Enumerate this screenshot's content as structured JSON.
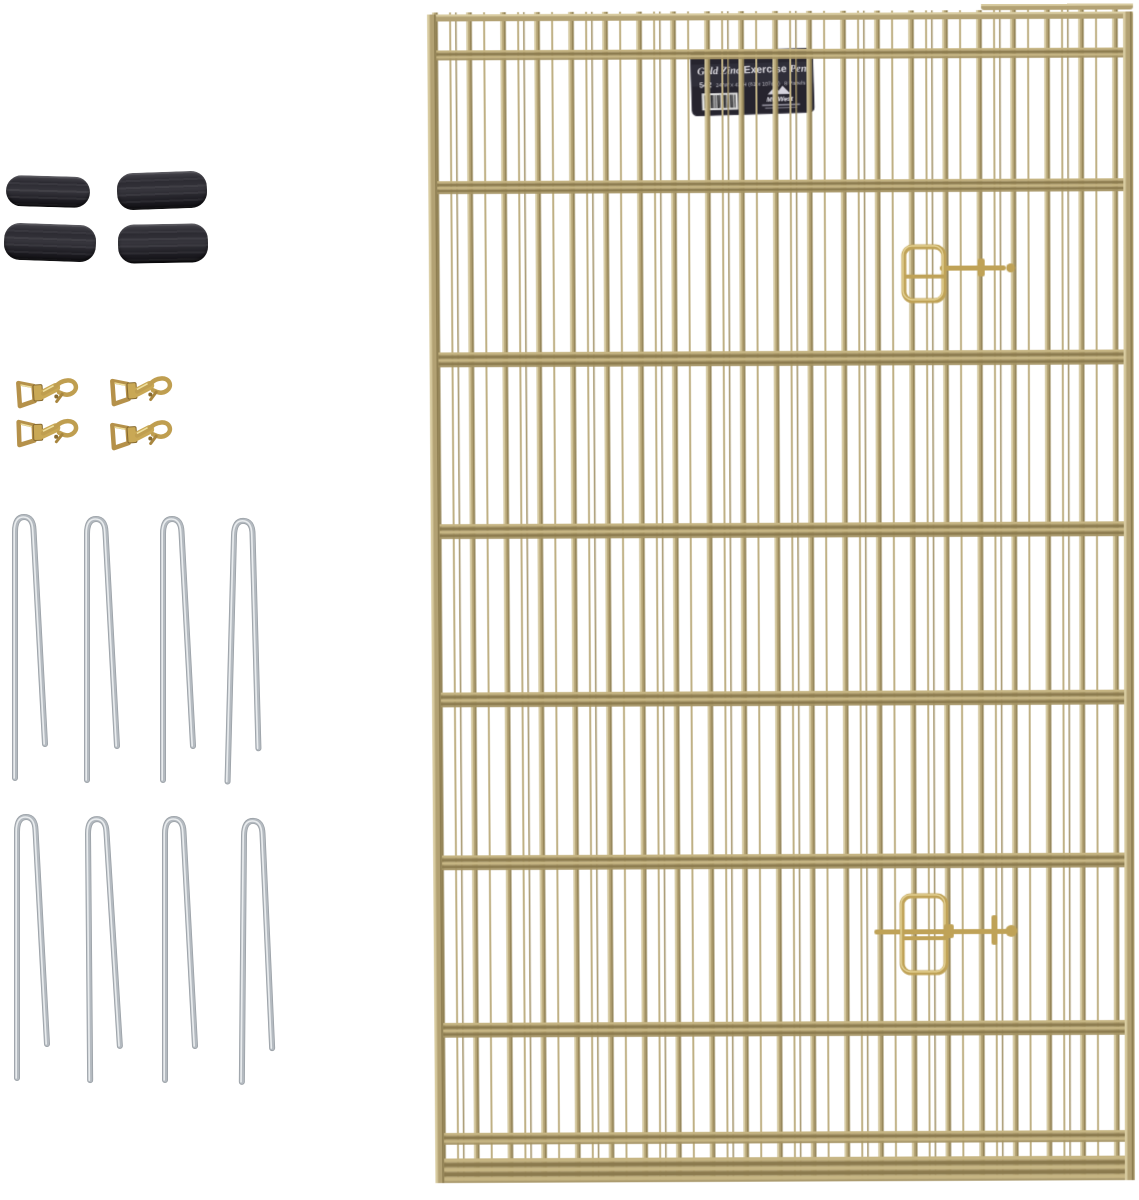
{
  "product": {
    "name": "gold-zinc-exercise-pen-with-accessories",
    "items": {
      "rubber_caps": {
        "count": 4,
        "color": "#2c2b31"
      },
      "snap_hooks": {
        "count": 4,
        "color": "#c9a855"
      },
      "ground_stakes": {
        "count": 8,
        "color": "#c6cacf"
      },
      "pen_panels": {
        "count": 8,
        "color": "#b2a173"
      }
    }
  },
  "pen_label": {
    "title_part1": "Gold Zinc",
    "title_part2": "Exercise",
    "title_part3": "Pen",
    "model": "542",
    "size": "24\"W x 42\"H (61 x 107cm)",
    "panels": "8 Panels",
    "brand": "MidWest",
    "bg_color": "#26242e",
    "text_color": "#d8d6dc"
  },
  "palette": {
    "background": "#ffffff",
    "wire_gold": "#b2a173",
    "wire_gold_light": "#d8cba0",
    "wire_gold_dark": "#8a7a4e",
    "band_light": "#c6b583",
    "band_dark": "#8b7a4e",
    "band_base": "#a59464",
    "latch_gold": "#bfa257",
    "stake_silver": "#b4bac0",
    "stake_highlight": "#e9ecee",
    "hook_brass": "#c9a855",
    "hook_brass_dark": "#876a30",
    "cap_black": "#232228",
    "barcode_bg": "#dcdcdc"
  }
}
